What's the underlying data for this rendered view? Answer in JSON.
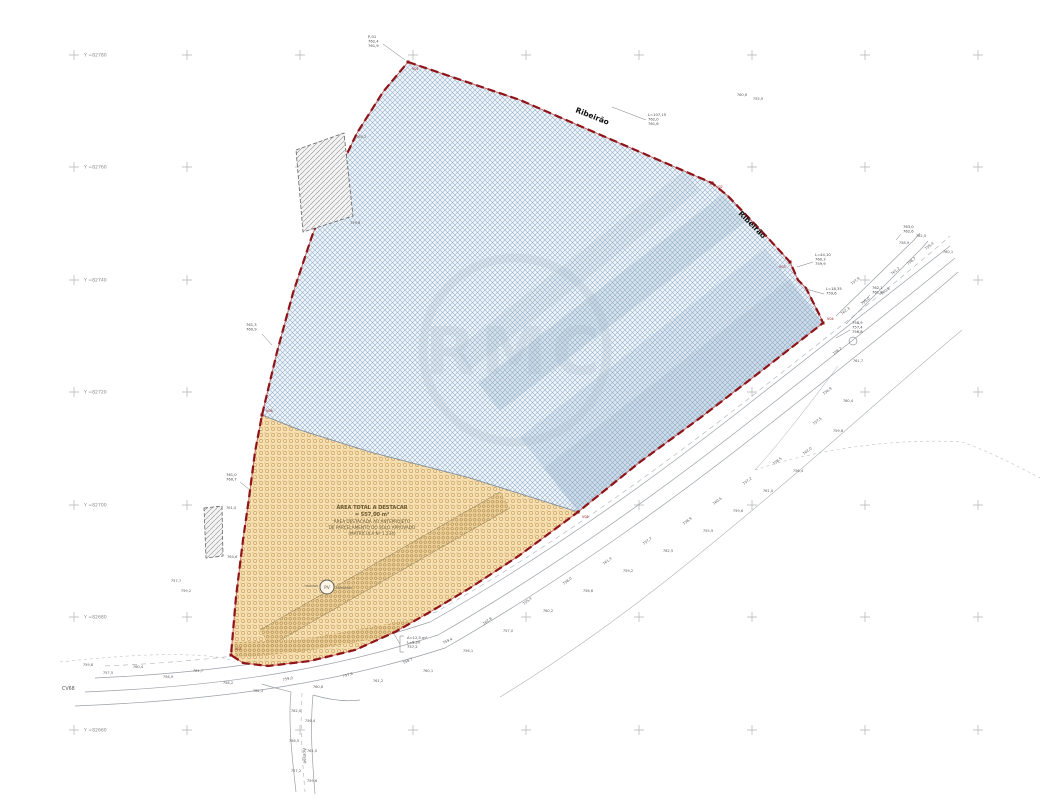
{
  "drawing": {
    "grid_y_labels": [
      "Y =82780",
      "Y =82760",
      "Y =82740",
      "Y =82720",
      "Y =82700",
      "Y =82680",
      "Y =82660"
    ],
    "area_note_lines": [
      "ÁREA TOTAL A DESTACAR",
      "= 557,00 m²",
      "ÁREA DESTACADA AO ANTEPROJETO",
      "DE PARCELAMENTO DO SOLO APROVADO",
      "(MATRÍCULA Nº 1.234)"
    ],
    "street_label_top": "Ribeirão",
    "street_label_right": "Ribeirão",
    "access_road_label": "Acesso",
    "cv_label": "CV68",
    "pv_label": "PV",
    "watermark_text": "RMC",
    "building_labels": {
      "b1_top": "760,2",
      "b1_bottom": "759,8",
      "b2_top": "761,0",
      "b2_bottom": "760,6"
    },
    "vertex_labels": [
      "V01",
      "V02",
      "V03",
      "V04",
      "V05",
      "V06",
      "V07"
    ],
    "annotations": [
      {
        "lines": [
          "P-01",
          "762,4",
          "761,9"
        ]
      },
      {
        "lines": [
          "L=107,15",
          "762,0",
          "761,6"
        ]
      },
      {
        "lines": [
          "L=44,10",
          "760,3",
          "759,9"
        ]
      },
      {
        "lines": [
          "L=18,35",
          "759,6"
        ]
      },
      {
        "lines": [
          "758,9",
          "757,4",
          "756,8"
        ]
      },
      {
        "lines": [
          "761,3",
          "760,9"
        ]
      },
      {
        "lines": [
          "761,0",
          "760,7"
        ]
      },
      {
        "lines": [
          "A=12,5 m²",
          "L=8,20",
          "757,2"
        ]
      },
      {
        "lines": [
          "762,1",
          "761,8"
        ]
      },
      {
        "lines": [
          "763,0",
          "762,6"
        ]
      }
    ],
    "spot_elevations": [
      "759,4",
      "760,1",
      "758,7",
      "761,2",
      "757,9",
      "760,8",
      "759,0",
      "762,3",
      "758,2",
      "761,7",
      "756,9",
      "760,4",
      "757,5",
      "759,8",
      "762,0",
      "756,4",
      "758,5",
      "761,0",
      "757,2",
      "759,6",
      "760,6",
      "755,9",
      "758,9",
      "762,5",
      "757,7",
      "759,2",
      "761,4",
      "756,6",
      "758,0",
      "760,2",
      "755,4",
      "757,0",
      "762,8",
      "756,1"
    ],
    "colors": {
      "boundary": "#8f1317",
      "blue_hatch": "#93afc8",
      "orange_fill": "#f7e0b2",
      "orange_dot": "#c49a58"
    }
  }
}
